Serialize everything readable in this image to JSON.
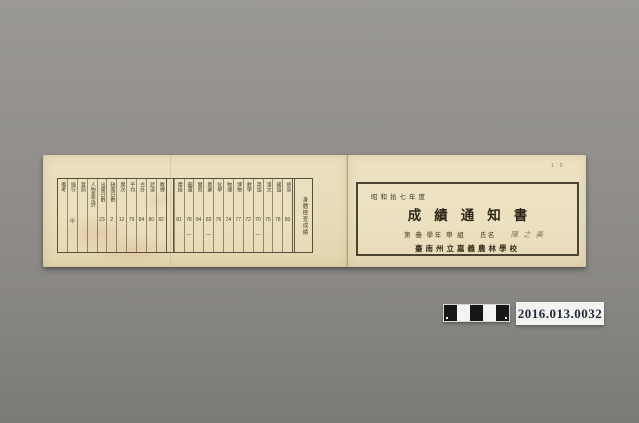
{
  "photo": {
    "background_color": "#8f8d89",
    "catalog_label": "2016.013.0032",
    "corner_mark": "1 8",
    "label_text_color": "#232a3d",
    "paper_color": "#e8ddbb",
    "ink_color": "#3e3523"
  },
  "scale_bar": {
    "squares": [
      "#161616",
      "#f4f4f2",
      "#161616",
      "#f4f4f2",
      "#161616"
    ]
  },
  "document": {
    "right_page": {
      "year_line": "昭和拾七年度",
      "title": "成績通知書",
      "grade_line": {
        "p1": "第",
        "grade": "叁",
        "p2": "學年",
        "class": "甲",
        "p3": "組",
        "name_label": "氏名",
        "name": "陳之美"
      },
      "school": "臺南州立嘉義農林學校"
    },
    "left_page": {
      "exam_label": "身體檢查成績",
      "columns": [
        {
          "h": "備考",
          "v": ""
        },
        {
          "h": "操行",
          "v": "甲",
          "hand": true
        },
        {
          "h": "賞罰",
          "v": ""
        },
        {
          "h": "人物查定評",
          "v": ""
        },
        {
          "h": "出席日數",
          "v": "23"
        },
        {
          "h": "缺席日數",
          "v": "2"
        },
        {
          "h": "席次",
          "v": "12"
        },
        {
          "h": "平均",
          "v": "79"
        },
        {
          "h": "合計",
          "v": "84"
        },
        {
          "h": "武道",
          "v": "80"
        },
        {
          "h": "教練",
          "v": "82"
        },
        {
          "gap": true
        },
        {
          "h": "體操",
          "v": "81"
        },
        {
          "h": "圖畫",
          "v": "78",
          "d": true
        },
        {
          "h": "實習",
          "v": "84"
        },
        {
          "h": "農業",
          "v": "83",
          "d": true
        },
        {
          "h": "化學",
          "v": "76"
        },
        {
          "h": "物理",
          "v": "74"
        },
        {
          "h": "博物",
          "v": "77"
        },
        {
          "h": "數學",
          "v": "72"
        },
        {
          "h": "英語",
          "v": "70",
          "d": true
        },
        {
          "h": "漢文",
          "v": "75"
        },
        {
          "h": "國語",
          "v": "78"
        },
        {
          "h": "修身",
          "v": "80"
        },
        {
          "wide": true,
          "h": "身體檢查成績"
        }
      ]
    }
  }
}
